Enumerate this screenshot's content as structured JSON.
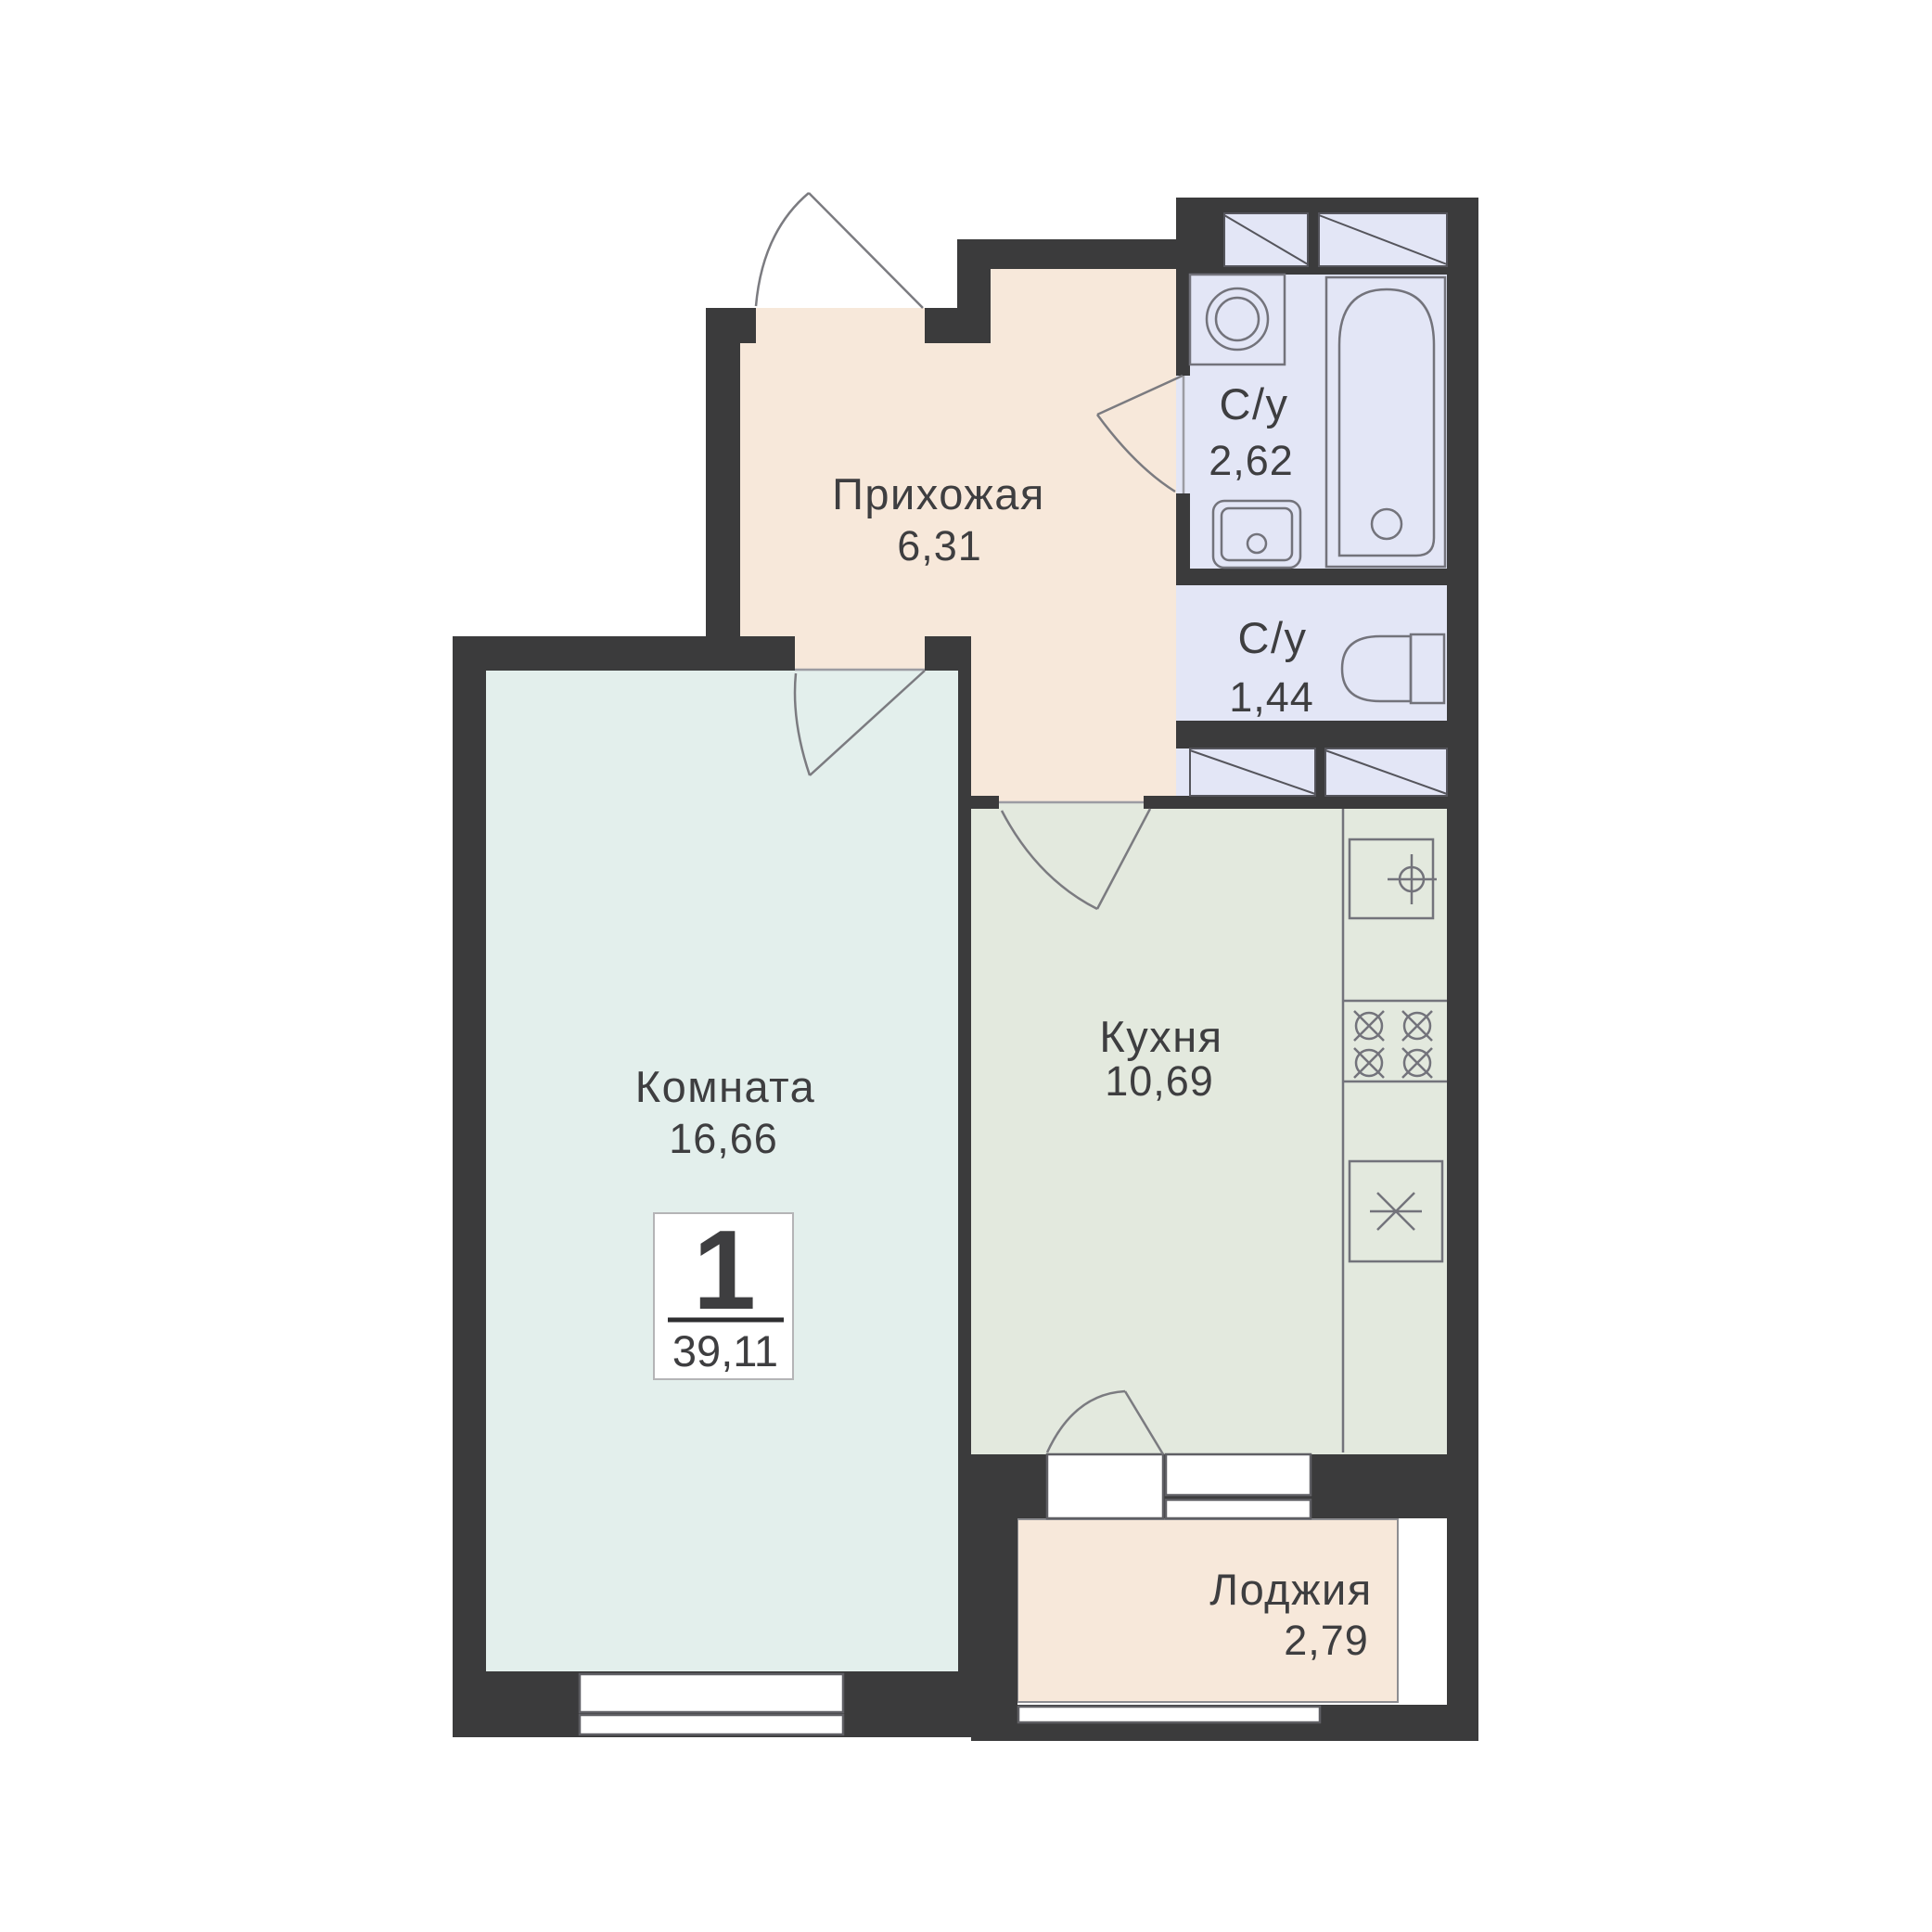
{
  "plan": {
    "type": "apartment-floor-plan",
    "badge": {
      "rooms_count": "1",
      "total_area": "39,11"
    },
    "rooms": [
      {
        "id": "hallway",
        "name": "Прихожая",
        "area": "6,31"
      },
      {
        "id": "bathroom",
        "name": "С/у",
        "area": "2,62"
      },
      {
        "id": "wc",
        "name": "С/у",
        "area": "1,44"
      },
      {
        "id": "living-room",
        "name": "Комната",
        "area": "16,66"
      },
      {
        "id": "kitchen",
        "name": "Кухня",
        "area": "10,69"
      },
      {
        "id": "loggia",
        "name": "Лоджия",
        "area": "2,79"
      }
    ],
    "fixtures": [
      "washing-machine",
      "bathtub",
      "bathroom-sink",
      "toilet",
      "kitchen-sink",
      "stove-4-burners",
      "fridge",
      "entrance-door",
      "room-door",
      "bathroom-door",
      "kitchen-door",
      "balcony-door",
      "window",
      "loggia-glazing",
      "ventilation-shafts"
    ],
    "colors": {
      "walls": "#3b3b3c",
      "hallway": "#f7e8da",
      "room": "#e3efec",
      "kitchen": "#e3e9de",
      "sanitary": "#e3e6f6",
      "loggia": "#f7e8da",
      "text": "#3e3e40",
      "background": "#ffffff"
    }
  }
}
